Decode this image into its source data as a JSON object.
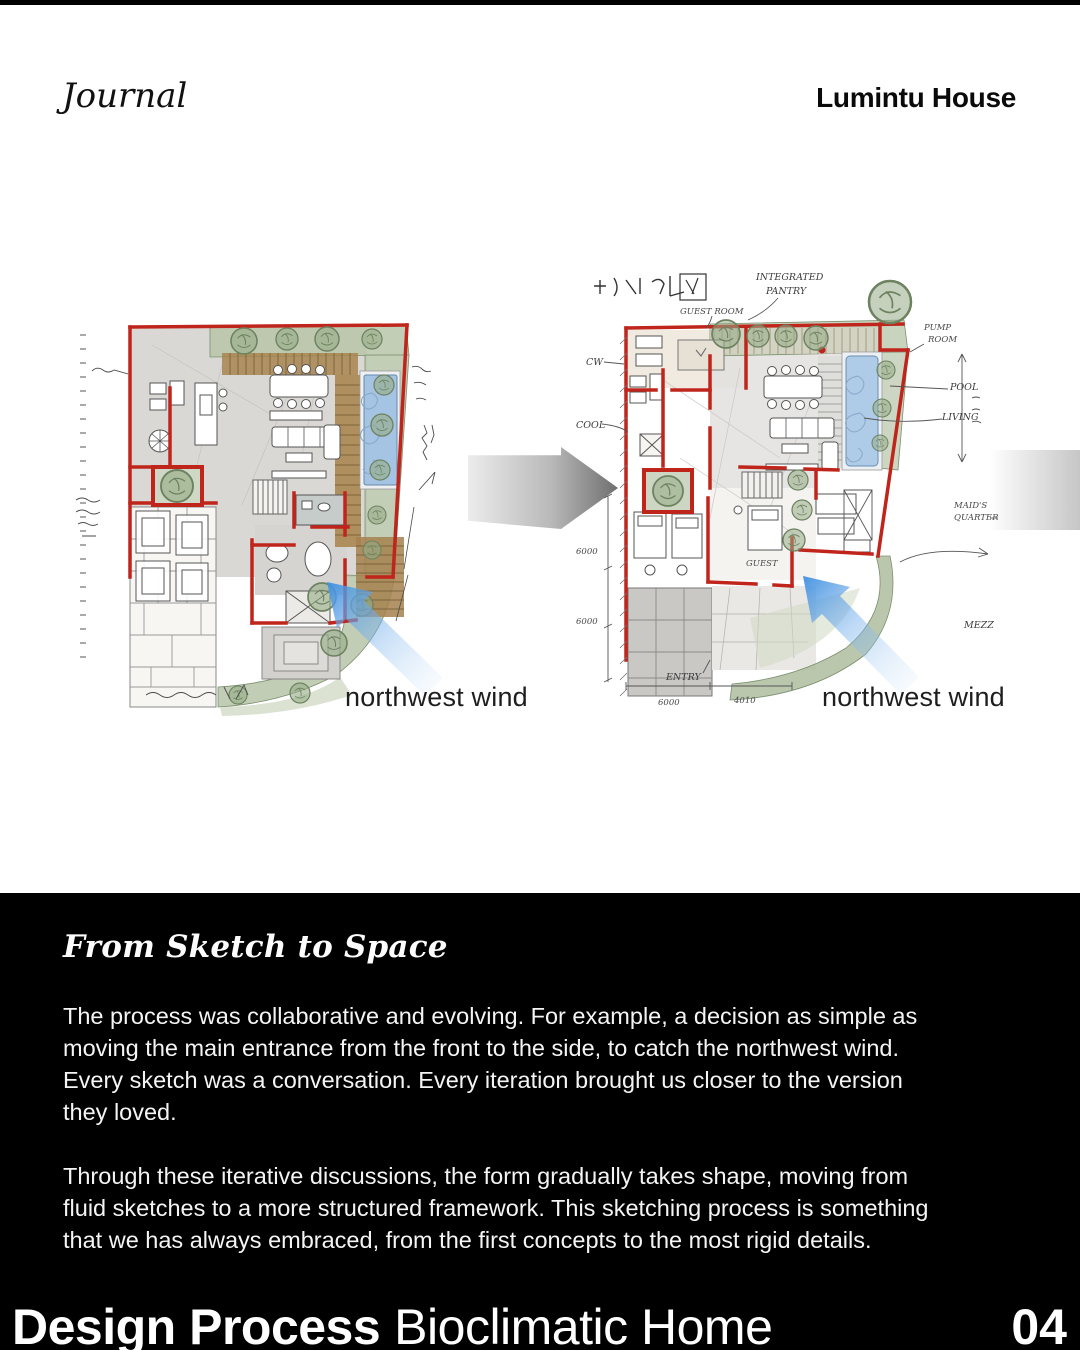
{
  "header": {
    "brand": "Journal",
    "project": "Lumintu House"
  },
  "sketches": {
    "left": {
      "wind_label": "northwest wind"
    },
    "right": {
      "wind_label": "northwest wind",
      "annotations": {
        "integrated": "INTEGRATED",
        "pantry": "PANTRY",
        "guest_room": "GUEST ROOM",
        "pump1": "PUMP",
        "pump2": "ROOM",
        "cw": "CW",
        "cool": "COOL",
        "pool": "POOL",
        "living": "LIVING",
        "maids1": "MAID'S",
        "maids2": "QUARTER",
        "guest": "GUEST",
        "entry": "ENTRY",
        "mezz": "MEZZ",
        "dim_left_a": "6000",
        "dim_left_b": "6000",
        "dim_bottom_a": "6000",
        "dim_bottom_b": "4010"
      }
    }
  },
  "story": {
    "heading": "From Sketch to Space",
    "p1": [
      "The process was collaborative and evolving. For example, a decision as simple as",
      "moving the main entrance from the front to the side, to catch the northwest wind.",
      "Every sketch was a conversation. Every iteration brought us closer to the version",
      "they loved."
    ],
    "p2": [
      "Through these iterative discussions, the form gradually takes shape, moving from",
      "fluid sketches to a more structured framework. This sketching process is something",
      "that we has always embraced, from the first concepts to the most rigid details."
    ]
  },
  "footer": {
    "title_bold": "Design Process",
    "title_regular": "Bioclimatic Home",
    "page_number": "04"
  },
  "colors": {
    "accent_red": "#c0251c",
    "wind_blue": "#4e9ce8",
    "pool_blue": "#aecbe8",
    "garden_green": "#b5c3a6",
    "deck_brown": "#a8854f",
    "section_bg": "#000000"
  }
}
